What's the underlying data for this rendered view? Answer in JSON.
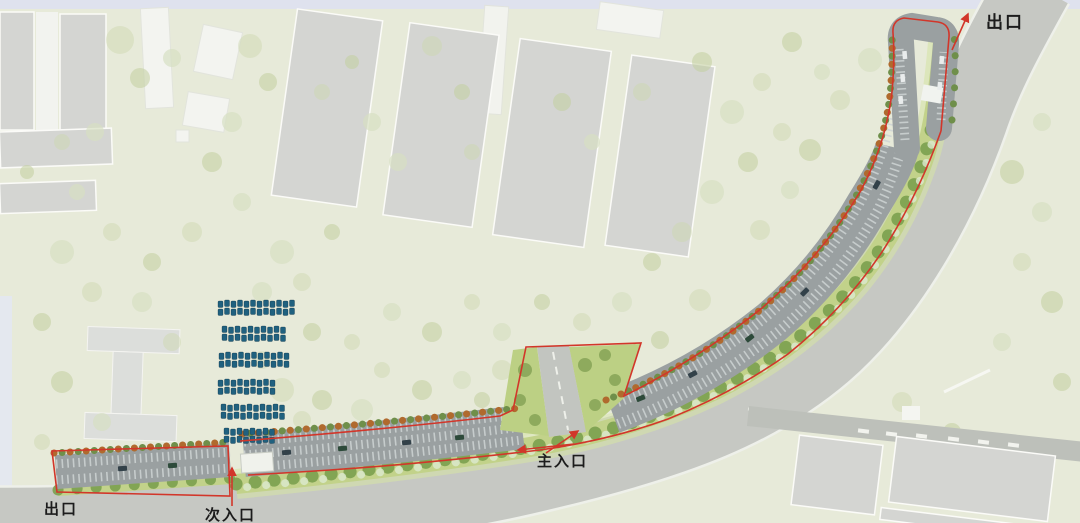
{
  "plan": {
    "type": "landscape-site-plan",
    "subject": "curved roadside parking strip with planting belt"
  },
  "annotations": [
    {
      "id": "exit-top-right",
      "label": "出口",
      "arrow": "up"
    },
    {
      "id": "main-entrance",
      "label": "主入口",
      "arrow": "up-from-road"
    },
    {
      "id": "secondary-entrance",
      "label": "次入口",
      "arrow": "up"
    },
    {
      "id": "exit-bottom-left",
      "label": "出口"
    }
  ],
  "features": {
    "blue_vehicle_rows": 6,
    "parking_sections": 4,
    "entrance_count": 2,
    "exit_count": 2
  },
  "colors": {
    "bg": "#e7ead9",
    "top_strip": "#dfe2ee",
    "left_strip": "#e3e8f1",
    "road_gray": "#c6c8c3",
    "road_edge": "#eef0ea",
    "parking_gray": "#9aa0a1",
    "stall_white": "#ced3d3",
    "belt_green": "#c2d28a",
    "belt_light": "#d6e2a6",
    "tree_dark": "#7ba04e",
    "tree_orange": "#b06a2e",
    "accent_red": "#d2362a",
    "car_blue": "#20617f",
    "building_gray": "#d4d5d2",
    "building_white": "#f3f4f0",
    "label_dark": "#1c1c1c"
  }
}
